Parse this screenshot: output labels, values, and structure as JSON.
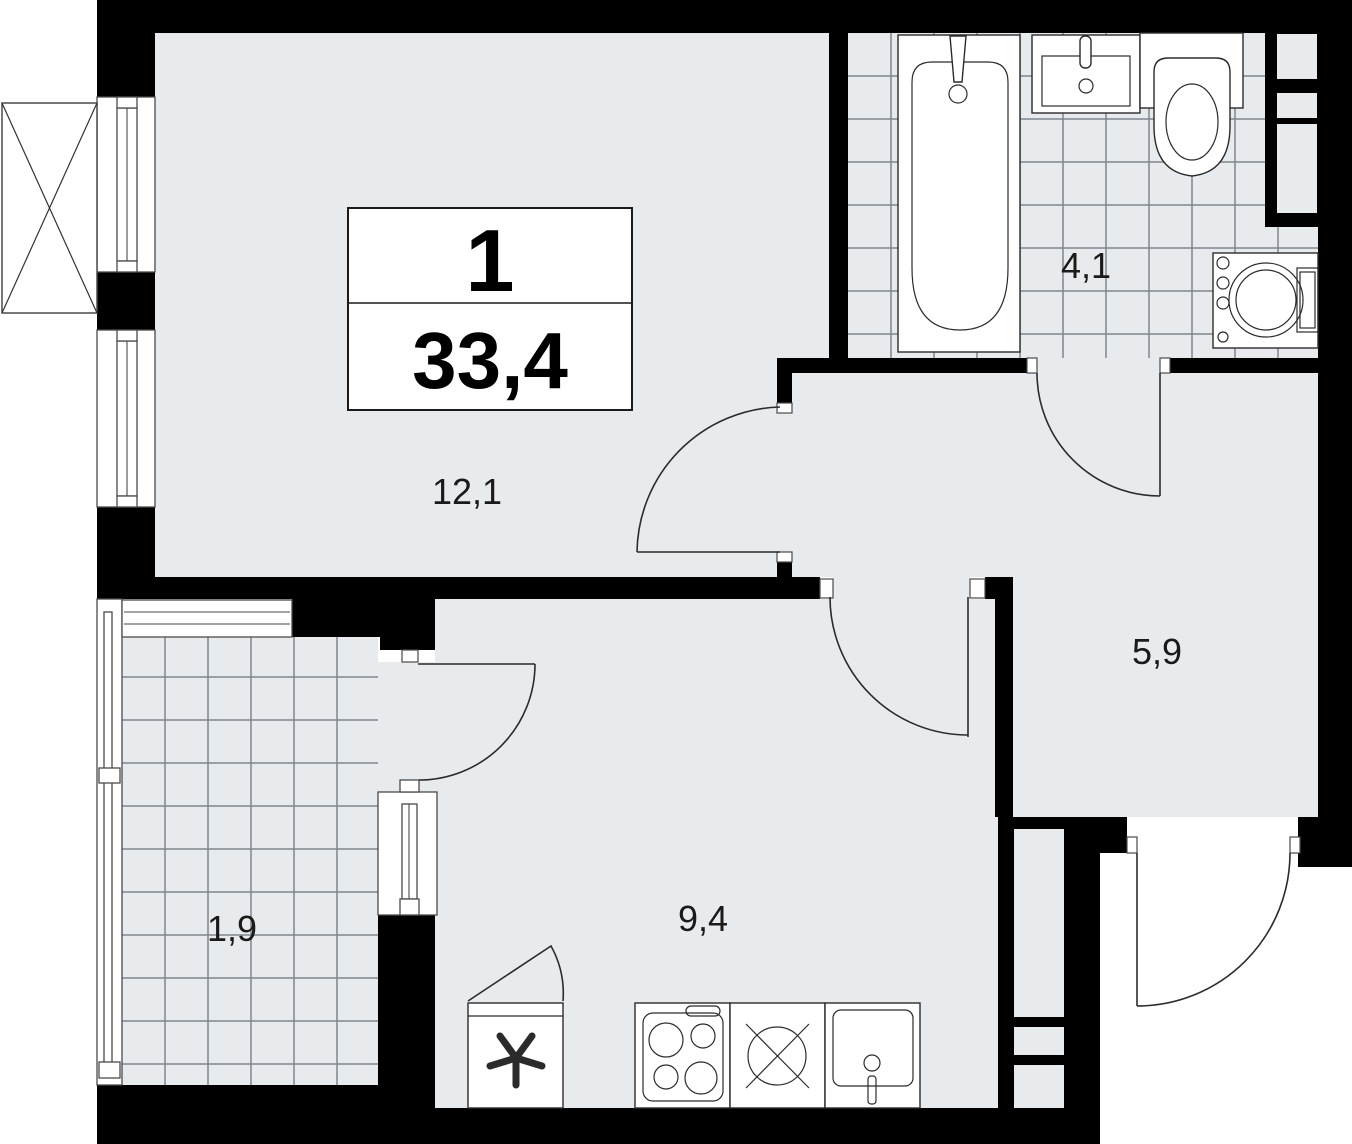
{
  "plan": {
    "title_block": {
      "rooms_count": "1",
      "total_area": "33,4"
    },
    "rooms": [
      {
        "name": "living-room",
        "area_label": "12,1"
      },
      {
        "name": "bathroom",
        "area_label": "4,1"
      },
      {
        "name": "hallway",
        "area_label": "5,9"
      },
      {
        "name": "kitchen",
        "area_label": "9,4"
      },
      {
        "name": "balcony",
        "area_label": "1,9"
      }
    ],
    "fixtures": [
      "bathtub",
      "bathroom-sink",
      "toilet",
      "washing-machine",
      "refrigerator",
      "stove",
      "kitchen-sink",
      "dishwasher",
      "ventilation-shaft",
      "exterior-unit"
    ],
    "colors": {
      "wall": "#000000",
      "floor": "#e8ebee",
      "tile_line": "#7f868c",
      "ink": "#1a1a1a",
      "fixture_line": "#2b2b2b",
      "background": "#ffffff"
    }
  }
}
